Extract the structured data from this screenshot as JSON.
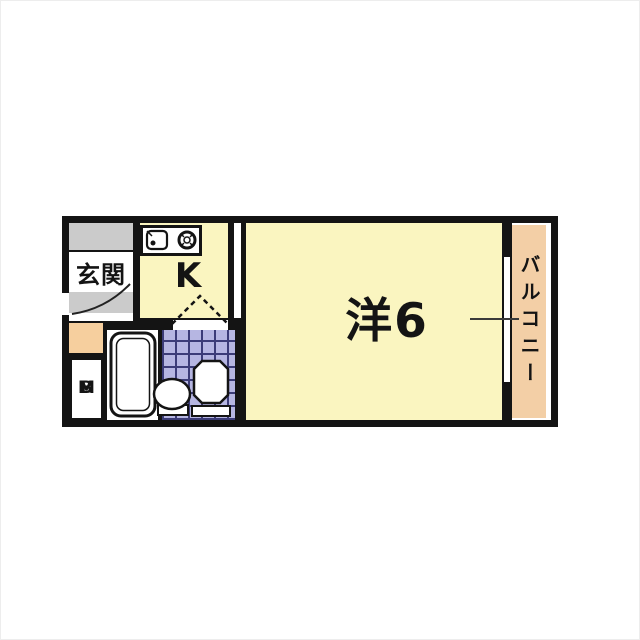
{
  "page": {
    "background_color": "#ffffff"
  },
  "floorplan": {
    "wall_color": "#141414",
    "rooms": {
      "genkan": {
        "label": "玄関",
        "floor_color": "#cbcbcb"
      },
      "kitchen": {
        "label": "K",
        "floor_color": "#faf5c0"
      },
      "main_room": {
        "label": "洋6",
        "floor_color": "#faf5c0"
      },
      "balcony": {
        "label": "バルコニー",
        "floor_color": "#f3cfa6"
      },
      "meter_box": {
        "letter_top": "M",
        "letter_bottom": "B",
        "floor_color": "#ffffff"
      },
      "bathroom": {
        "tile_color": "#b6b6e2",
        "tile_grid_color": "#3c3c78",
        "tub_area_color": "#ffffff"
      },
      "storage_box": {
        "color": "#f6cf9e"
      }
    },
    "icons": [
      {
        "name": "bathtub-icon"
      },
      {
        "name": "washbasin-icon"
      },
      {
        "name": "toilet-icon"
      },
      {
        "name": "kitchen-sink-icon"
      },
      {
        "name": "stove-burner-icon"
      },
      {
        "name": "door-swing-arc-icon"
      },
      {
        "name": "folding-door-icon"
      },
      {
        "name": "window-icon"
      },
      {
        "name": "window-tick-icon"
      }
    ]
  }
}
